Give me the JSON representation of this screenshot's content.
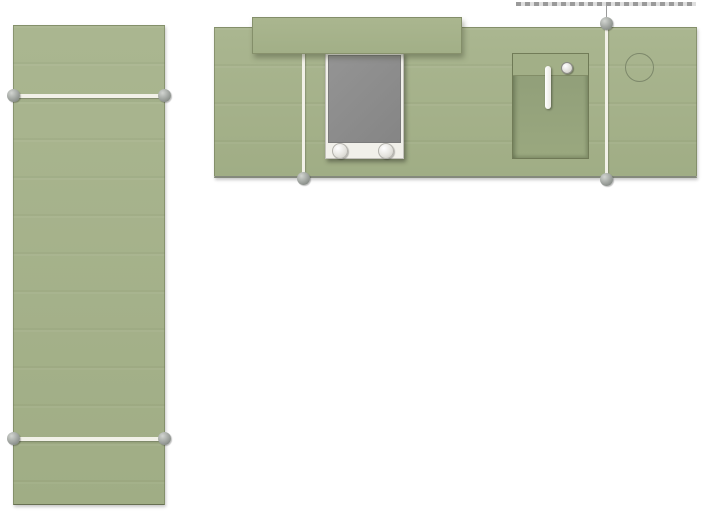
{
  "app": {
    "view": "kitchen-plan-top-view",
    "background": "#ffffff"
  },
  "palette": {
    "slab_green_1": "#aab690",
    "slab_green_2": "#a0ad85",
    "shelf_green": "#a2af87",
    "basin_green_1": "#8f9d78",
    "basin_green_2": "#9aa87f",
    "appliance_gray_1": "#949494",
    "appliance_gray_2": "#858585",
    "frame_white": "#f1f0ea",
    "seam_white": "#f2f1e8",
    "joint_gray_1": "#d2d5d1",
    "joint_gray_2": "#8e938e",
    "edge_dark": "#84897c",
    "guide_gray": "#9a9a9a",
    "outline_green": "#7d886b"
  },
  "objects": {
    "left_counter": {
      "name": "left counter run",
      "seam_count": 2,
      "joint_count": 4
    },
    "top_counter": {
      "name": "top counter run",
      "seam_count": 2
    },
    "shelf": {
      "name": "raised shelf"
    },
    "cooktop": {
      "name": "cooktop module",
      "knob_count": 2
    },
    "sink": {
      "name": "sink basin",
      "has_faucet": true
    },
    "circular_cutout": {
      "name": "circular cutout outline"
    },
    "wall_guide": {
      "name": "dashed wall guide line"
    }
  }
}
